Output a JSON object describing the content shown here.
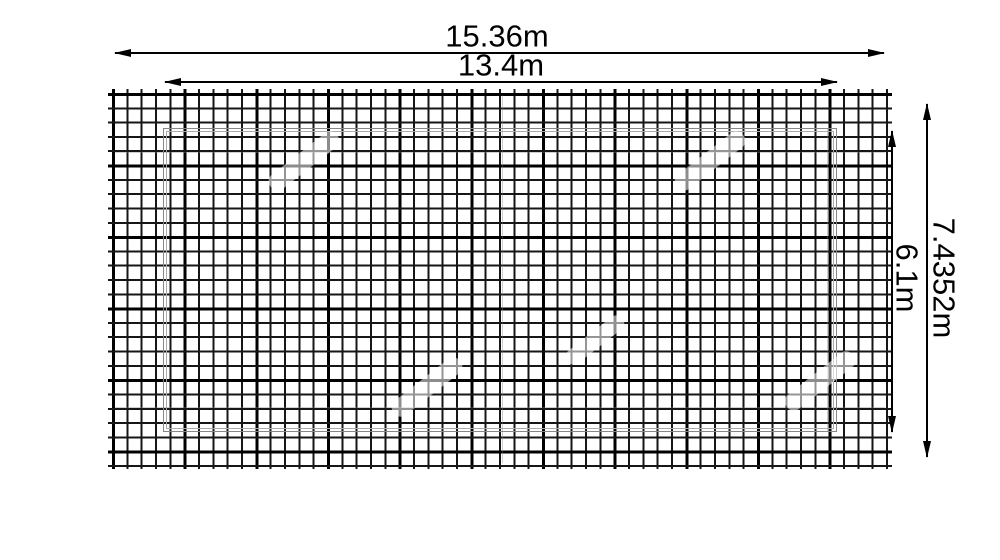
{
  "diagram": {
    "type": "dimensioned-grid-drawing",
    "dimensions": {
      "outer_width": "15.36m",
      "inner_width": "13.4m",
      "outer_height": "7.4352m",
      "inner_height": "6.1m"
    },
    "grid": {
      "columns": 54,
      "rows": 26
    },
    "colors": {
      "background": "#ffffff",
      "grid_line": "#161616",
      "grid_line_bold": "#000000",
      "screen_outline_dark": "#878787",
      "screen_outline_light": "#ababab",
      "dimension_line": "#000000"
    }
  }
}
